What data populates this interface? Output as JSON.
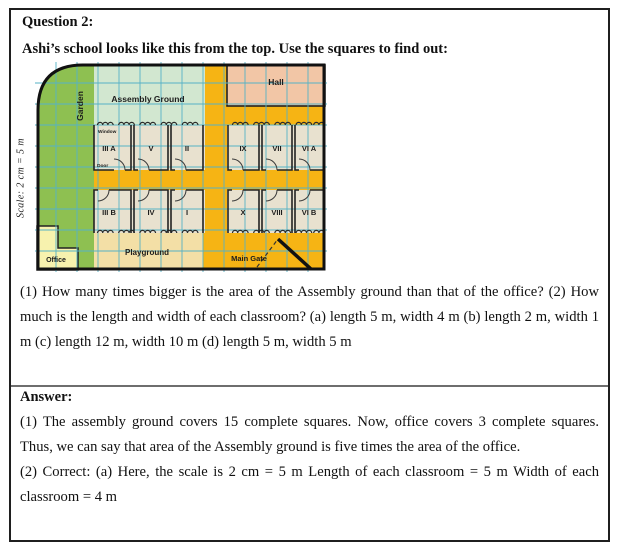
{
  "question": {
    "label": "Question 2:",
    "intro": "Ashi’s school looks like this from the top. Use the squares to find out:",
    "body": "(1) How many times bigger is the area of the Assembly ground than that of the office? (2) How much is the length and width of each classroom? (a) length 5 m, width 4 m (b) length 2 m, width 1 m (c) length 12 m, width 10 m (d) length 5 m, width 5 m"
  },
  "map": {
    "scale_label": "Scale: 2 cm = 5 m",
    "regions": {
      "garden": "Garden",
      "assembly": "Assembly Ground",
      "hall": "Hall",
      "playground": "Playground",
      "office": "Office",
      "main_gate": "Main Gate"
    },
    "annotations": {
      "window": "Window",
      "door": "Door"
    },
    "classrooms_top": [
      "III A",
      "V",
      "II",
      "IX",
      "VII",
      "VI A"
    ],
    "classrooms_bottom": [
      "III B",
      "IV",
      "I",
      "X",
      "VIII",
      "VI B"
    ],
    "colors": {
      "garden": "#8ec051",
      "assembly": "#d2e7d0",
      "hall": "#f2c6a6",
      "corridor": "#f6b414",
      "classroom": "#e8e1cf",
      "playground": "#f3dfa6",
      "office": "#f7f2ae",
      "grid": "#56b2c6"
    }
  },
  "answer": {
    "label": "Answer:",
    "part1": "(1) The assembly ground covers 15 complete squares. Now, office covers 3 complete squares. Thus, we can say that area of the Assembly ground is five times the area of the office.",
    "part2": "(2) Correct: (a) Here, the scale is 2 cm = 5 m Length of each classroom = 5 m Width of each classroom = 4 m"
  }
}
